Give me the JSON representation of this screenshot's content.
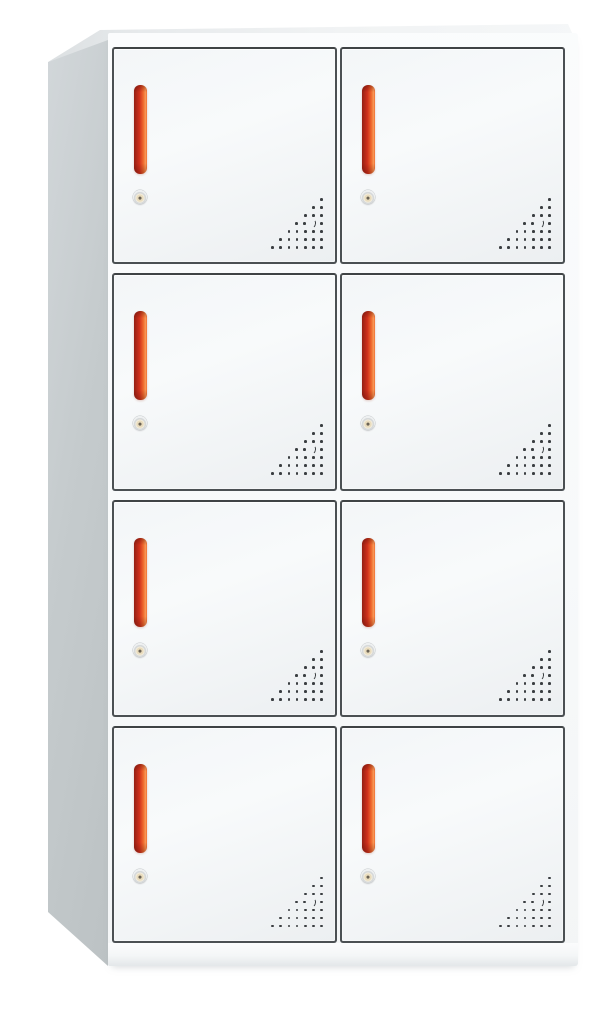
{
  "meta": {
    "description": "Product photo of a white steel 8-door locker cabinet with red bar handles, round key locks and corner dot-perforation vents",
    "view": "front-left three-quarter view on white background"
  },
  "cabinet": {
    "rows": 4,
    "columns": 2,
    "door_count": 8,
    "doors": [
      {
        "id": "door-r1-c1",
        "row": 1,
        "col": 1
      },
      {
        "id": "door-r1-c2",
        "row": 1,
        "col": 2
      },
      {
        "id": "door-r2-c1",
        "row": 2,
        "col": 1
      },
      {
        "id": "door-r2-c2",
        "row": 2,
        "col": 2
      },
      {
        "id": "door-r3-c1",
        "row": 3,
        "col": 1
      },
      {
        "id": "door-r3-c2",
        "row": 3,
        "col": 2
      },
      {
        "id": "door-r4-c1",
        "row": 4,
        "col": 1
      },
      {
        "id": "door-r4-c2",
        "row": 4,
        "col": 2
      }
    ],
    "door_features": {
      "handle": "vertical-red-bar-handle",
      "lock": "round-key-lock",
      "vent": "corner-dot-perforation-triangle"
    },
    "vent_pattern": {
      "rows_from_top": [
        1,
        2,
        3,
        4,
        5,
        6,
        7
      ],
      "crescent_row_index": 3,
      "crescent_pos_from_right": 1
    },
    "colors": {
      "background": "#ffffff",
      "frame": "#fbfcfd",
      "door_face": "#f3f6f8",
      "door_face_edge": "#eceff1",
      "door_border": "#4b5053",
      "side_panel_light": "#d2d7da",
      "side_panel": "#c5cbcd",
      "side_panel_dark": "#bcc2c4",
      "top_face_left": "#dbdfe1",
      "top_face": "#f1f3f4",
      "handle_dark": "#941f13",
      "handle_red": "#d0301c",
      "handle_orange": "#ef6a2e",
      "handle_highlight": "#f89a58",
      "lock_ring": "#d6d9da",
      "lock_face": "#e9dcbd",
      "lock_keyhole": "#6a6254",
      "vent_dot": "#3a3e41",
      "base_shadow": "#e3e7e9"
    }
  }
}
